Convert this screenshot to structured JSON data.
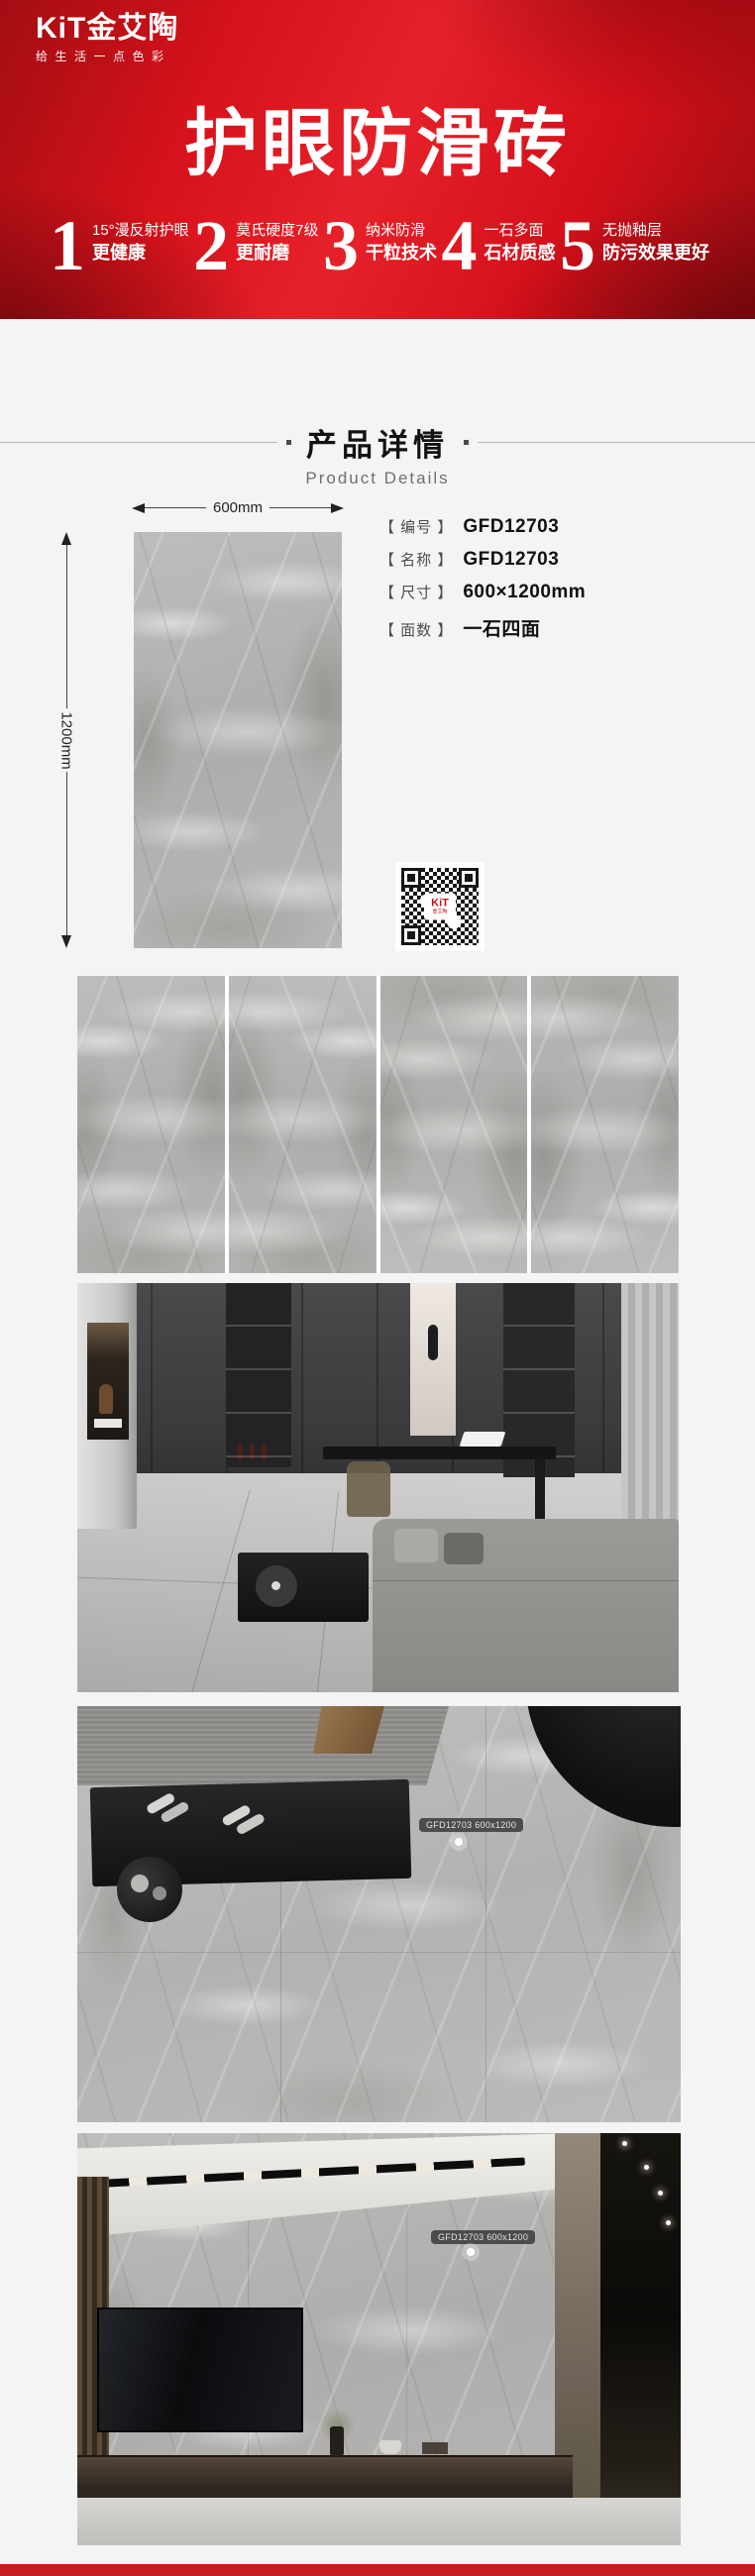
{
  "header": {
    "logo": {
      "brand": "KiT金艾陶",
      "tagline": "给生活一点色彩"
    },
    "title": "护眼防滑砖",
    "features": [
      {
        "num": "1",
        "line1": "15°漫反射护眼",
        "line2": "更健康"
      },
      {
        "num": "2",
        "line1": "莫氏硬度7级",
        "line2": "更耐磨"
      },
      {
        "num": "3",
        "line1": "纳米防滑",
        "line2": "干粒技术"
      },
      {
        "num": "4",
        "line1": "一石多面",
        "line2": "石材质感"
      },
      {
        "num": "5",
        "line1": "无抛釉层",
        "line2": "防污效果更好"
      }
    ]
  },
  "section_header": {
    "title": "产品详情",
    "subtitle": "Product Details"
  },
  "product": {
    "dim_width": "600mm",
    "dim_height": "1200mm",
    "specs": [
      {
        "label": "【 编号 】",
        "value": "GFD12703"
      },
      {
        "label": "【 名称 】",
        "value": "GFD12703"
      },
      {
        "label": "【 尺寸 】",
        "value": "600×1200mm"
      },
      {
        "label": "【 面数 】",
        "value": "一石四面"
      }
    ],
    "qr_brand": "KiT",
    "qr_brand_sub": "金艾陶"
  },
  "hotspots": {
    "floor_tag": "GFD12703 600x1200",
    "wall_tag": "GFD12703 600x1200"
  },
  "colors": {
    "brand_red": "#d9121a",
    "footer_red": "#c41d23",
    "page_bg": "#f4f4f5",
    "tile_gray": "#b4b3b1"
  }
}
